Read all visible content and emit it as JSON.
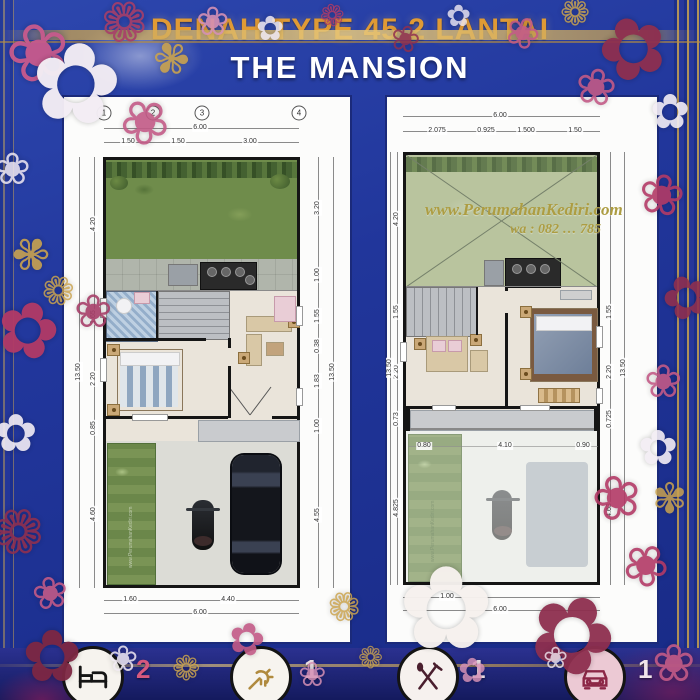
{
  "title": {
    "line1": "DENAH TYPE 45 2 LANTAI",
    "line2": "THE MANSION"
  },
  "watermark": {
    "site": "www.PerumahanKediri.com",
    "contact": "wa : 082 … 785"
  },
  "colors": {
    "background": "#21369b",
    "title_gold": "#e09a35",
    "title_white": "#ffffff",
    "frame_gold": "#c9a24e",
    "flower_pink": "#c25a86",
    "flower_maroon": "#8e2f4f",
    "panel_white": "#fcfcfb",
    "grass_green": "#6f8c4b",
    "void_green": "#b9c49e",
    "floor_beige": "#eae4da",
    "bath_blue": "#a8c0d8",
    "legend_accent": "#d6597e"
  },
  "plans": [
    {
      "name": "lantai-1",
      "column_markers": [
        "1",
        "2",
        "3",
        "4"
      ],
      "dims_top": {
        "total": "6.00",
        "segments": [
          "1.50",
          "1.50",
          "3.00"
        ]
      },
      "dims_bottom": {
        "total": "6.00",
        "segments": [
          "1.60",
          "4.40"
        ]
      },
      "dims_left": {
        "total": "13.50",
        "segments": [
          "4.20",
          "1.65",
          "2.20",
          "0.85",
          "4.60"
        ]
      },
      "dims_right": {
        "total": "13.50",
        "segments": [
          "3.20",
          "1.00",
          "1.55",
          "0.38",
          "1.83",
          "1.00",
          "4.55"
        ]
      }
    },
    {
      "name": "lantai-2",
      "dims_top": {
        "total": "6.00",
        "segments": [
          "2.075",
          "0.925",
          "1.500",
          "1.50"
        ]
      },
      "dims_bottom": {
        "total": "6.00",
        "segments": [
          "1.00"
        ]
      },
      "dims_left": {
        "total": "13.50",
        "segments": [
          "4.20",
          "1.55",
          "2.20",
          "0.73",
          "4.825"
        ]
      },
      "dims_right": {
        "total": "13.50",
        "segments": [
          "1.55",
          "2.20",
          "0.725",
          "4.63"
        ]
      },
      "dims_inner": [
        "0.80",
        "4.10",
        "0.90"
      ]
    }
  ],
  "legend": {
    "items": [
      {
        "icon": "bed-icon",
        "count": "2"
      },
      {
        "icon": "shower-icon",
        "count": "1"
      },
      {
        "icon": "cutlery-icon",
        "count": "1"
      },
      {
        "icon": "car-icon",
        "count": "1"
      }
    ]
  },
  "decor": {
    "flowers": [
      {
        "g": "❀",
        "x": 6,
        "y": 14,
        "s": 78,
        "c": "#c75a8c",
        "r": -15,
        "o": 0.95
      },
      {
        "g": "✿",
        "x": 30,
        "y": 28,
        "s": 110,
        "c": "#f3edf4",
        "r": 8,
        "o": 0.97
      },
      {
        "g": "❁",
        "x": 100,
        "y": -4,
        "s": 56,
        "c": "#a63e68",
        "r": 20,
        "o": 0.9
      },
      {
        "g": "✾",
        "x": 152,
        "y": 38,
        "s": 44,
        "c": "#c9a24e",
        "r": 35,
        "o": 0.9
      },
      {
        "g": "❀",
        "x": 196,
        "y": 2,
        "s": 40,
        "c": "#d490b4",
        "r": 0,
        "o": 0.9
      },
      {
        "g": "✿",
        "x": 256,
        "y": 12,
        "s": 34,
        "c": "#f0e9f2",
        "r": 0,
        "o": 0.85
      },
      {
        "g": "❁",
        "x": 320,
        "y": 2,
        "s": 30,
        "c": "#b23a66",
        "r": -10,
        "o": 0.85
      },
      {
        "g": "❀",
        "x": 390,
        "y": 22,
        "s": 36,
        "c": "#8e2f4f",
        "r": 15,
        "o": 0.85
      },
      {
        "g": "✿",
        "x": 446,
        "y": 2,
        "s": 30,
        "c": "#f0e9f2",
        "r": 0,
        "o": 0.8
      },
      {
        "g": "❀",
        "x": 505,
        "y": 12,
        "s": 42,
        "c": "#c25a86",
        "r": 25,
        "o": 0.9
      },
      {
        "g": "❁",
        "x": 560,
        "y": -4,
        "s": 36,
        "c": "#c9a24e",
        "r": 0,
        "o": 0.85
      },
      {
        "g": "✿",
        "x": 598,
        "y": 6,
        "s": 84,
        "c": "#8e2f4f",
        "r": -20,
        "o": 0.95
      },
      {
        "g": "❀",
        "x": 575,
        "y": 62,
        "s": 50,
        "c": "#c25a86",
        "r": 10,
        "o": 0.9
      },
      {
        "g": "✿",
        "x": 650,
        "y": 88,
        "s": 48,
        "c": "#f3edf4",
        "r": 0,
        "o": 0.9
      },
      {
        "g": "❀",
        "x": -6,
        "y": 148,
        "s": 44,
        "c": "#f0e9f2",
        "r": 0,
        "o": 0.85
      },
      {
        "g": "✾",
        "x": 12,
        "y": 232,
        "s": 46,
        "c": "#c9a24e",
        "r": -30,
        "o": 0.9
      },
      {
        "g": "✿",
        "x": -4,
        "y": 292,
        "s": 76,
        "c": "#b23a66",
        "r": 15,
        "o": 0.95
      },
      {
        "g": "❀",
        "x": 120,
        "y": 92,
        "s": 60,
        "c": "#c25a86",
        "r": 40,
        "o": 0.9
      },
      {
        "g": "❁",
        "x": 42,
        "y": 272,
        "s": 40,
        "c": "#c9a24e",
        "r": -15,
        "o": 0.85
      },
      {
        "g": "❀",
        "x": 74,
        "y": 288,
        "s": 46,
        "c": "#a63e68",
        "r": 0,
        "o": 0.9
      },
      {
        "g": "✿",
        "x": -6,
        "y": 408,
        "s": 52,
        "c": "#f3edf4",
        "r": 0,
        "o": 0.9
      },
      {
        "g": "❁",
        "x": -8,
        "y": 502,
        "s": 62,
        "c": "#8e2f4f",
        "r": 20,
        "o": 0.9
      },
      {
        "g": "❀",
        "x": 32,
        "y": 572,
        "s": 44,
        "c": "#c25a86",
        "r": -10,
        "o": 0.9
      },
      {
        "g": "✿",
        "x": 22,
        "y": 620,
        "s": 72,
        "c": "#7d2743",
        "r": 0,
        "o": 0.95
      },
      {
        "g": "❀",
        "x": 108,
        "y": 642,
        "s": 36,
        "c": "#f0e9f2",
        "r": 0,
        "o": 0.85
      },
      {
        "g": "❁",
        "x": 172,
        "y": 652,
        "s": 34,
        "c": "#c9a24e",
        "r": 0,
        "o": 0.85
      },
      {
        "g": "✿",
        "x": 228,
        "y": 618,
        "s": 44,
        "c": "#c25a86",
        "r": 15,
        "o": 0.9
      },
      {
        "g": "❀",
        "x": 298,
        "y": 658,
        "s": 34,
        "c": "#d490b4",
        "r": 0,
        "o": 0.85
      },
      {
        "g": "✿",
        "x": 398,
        "y": 552,
        "s": 115,
        "c": "#f6f1ee",
        "r": 0,
        "o": 0.97
      },
      {
        "g": "❁",
        "x": 328,
        "y": 588,
        "s": 40,
        "c": "#c9a24e",
        "r": -25,
        "o": 0.85
      },
      {
        "g": "✿",
        "x": 528,
        "y": 582,
        "s": 105,
        "c": "#8e2f4f",
        "r": 25,
        "o": 0.95
      },
      {
        "g": "❀",
        "x": 592,
        "y": 468,
        "s": 60,
        "c": "#b23a66",
        "r": -15,
        "o": 0.9
      },
      {
        "g": "✾",
        "x": 652,
        "y": 478,
        "s": 42,
        "c": "#c9a24e",
        "r": 0,
        "o": 0.85
      },
      {
        "g": "❀",
        "x": 638,
        "y": 168,
        "s": 56,
        "c": "#b23a66",
        "r": 10,
        "o": 0.9
      },
      {
        "g": "✿",
        "x": 662,
        "y": 268,
        "s": 58,
        "c": "#8e2f4f",
        "r": -20,
        "o": 0.9
      },
      {
        "g": "❀",
        "x": 644,
        "y": 358,
        "s": 46,
        "c": "#c25a86",
        "r": 0,
        "o": 0.9
      },
      {
        "g": "✿",
        "x": 638,
        "y": 424,
        "s": 48,
        "c": "#f3edf4",
        "r": 0,
        "o": 0.9
      },
      {
        "g": "❀",
        "x": 622,
        "y": 538,
        "s": 56,
        "c": "#b23a66",
        "r": 30,
        "o": 0.9
      },
      {
        "g": "❀",
        "x": 652,
        "y": 638,
        "s": 52,
        "c": "#c25a86",
        "r": 0,
        "o": 0.9
      },
      {
        "g": "❁",
        "x": 358,
        "y": 644,
        "s": 30,
        "c": "#c9a24e",
        "r": 0,
        "o": 0.8
      },
      {
        "g": "✿",
        "x": 458,
        "y": 654,
        "s": 34,
        "c": "#d490b4",
        "r": 0,
        "o": 0.85
      },
      {
        "g": "❀",
        "x": 543,
        "y": 644,
        "s": 30,
        "c": "#f0e9f2",
        "r": 0,
        "o": 0.8
      }
    ]
  }
}
